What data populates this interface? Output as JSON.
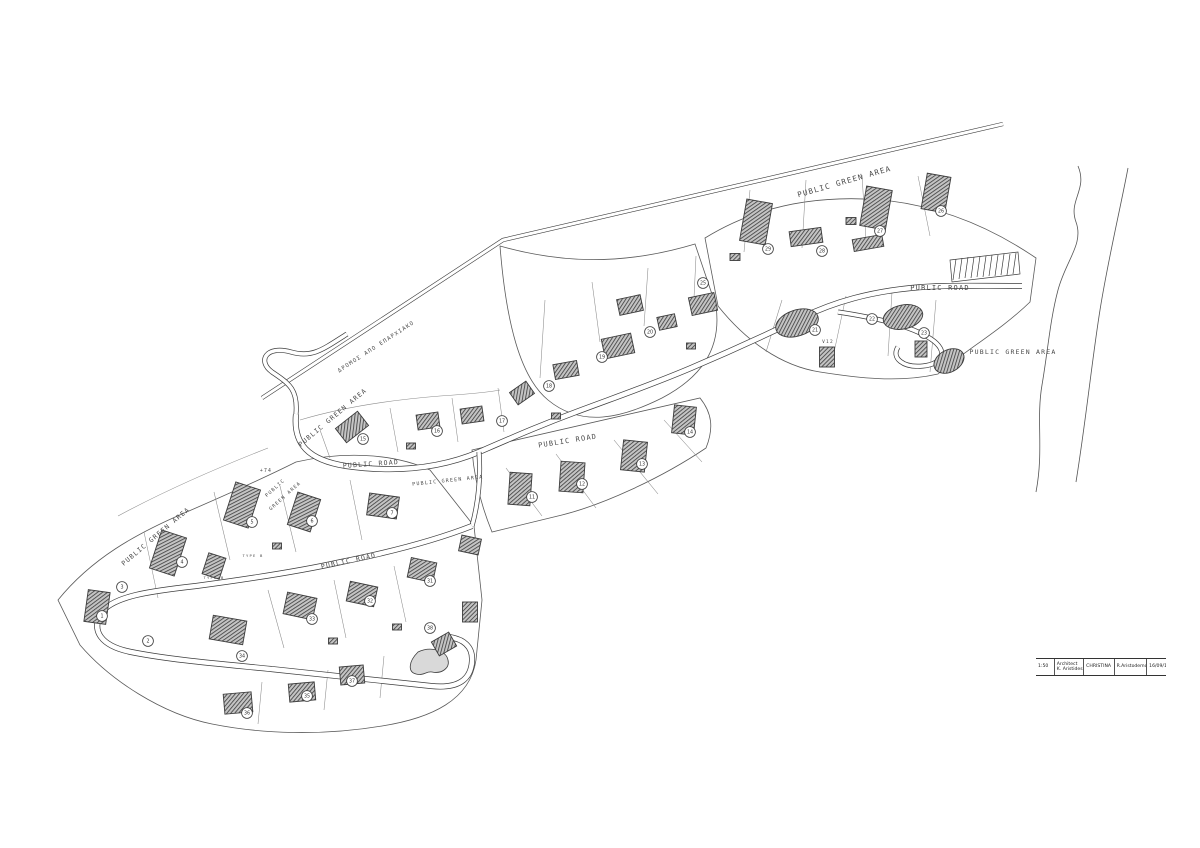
{
  "colors": {
    "line": "#3c3c3c",
    "faint": "#8a8a8a",
    "building_hatch": "#3a3a3a",
    "background": "#ffffff"
  },
  "labels": [
    {
      "text": "PUBLIC GREEN AREA",
      "x": 845,
      "y": 184,
      "rot": -16,
      "size": 7.5
    },
    {
      "text": "PUBLIC ROAD",
      "x": 940,
      "y": 290,
      "rot": 0,
      "size": 7
    },
    {
      "text": "PUBLIC GREEN AREA",
      "x": 1013,
      "y": 354,
      "rot": 0,
      "size": 6.5
    },
    {
      "text": "PUBLIC ROAD",
      "x": 568,
      "y": 443,
      "rot": -9,
      "size": 7
    },
    {
      "text": "PUBLIC ROAD",
      "x": 371,
      "y": 466,
      "rot": -4,
      "size": 6.5
    },
    {
      "text": "PUBLIC GREEN AREA",
      "x": 448,
      "y": 482,
      "rot": -6,
      "size": 5
    },
    {
      "text": "PUBLIC",
      "x": 276,
      "y": 489,
      "rot": -42,
      "size": 4.8
    },
    {
      "text": "GREEN AREA",
      "x": 286,
      "y": 497,
      "rot": -42,
      "size": 4.8
    },
    {
      "text": "+74",
      "x": 266,
      "y": 472,
      "rot": 0,
      "size": 4.8
    },
    {
      "text": "PUBLIC GREEN AREA",
      "x": 334,
      "y": 419,
      "rot": -40,
      "size": 6.5
    },
    {
      "text": "PUBLIC GREEN AREA",
      "x": 157,
      "y": 538,
      "rot": -40,
      "size": 6.5
    },
    {
      "text": "PUBLIC ROAD",
      "x": 349,
      "y": 563,
      "rot": -12,
      "size": 6.5
    },
    {
      "text": "ΔΡΟΜΟΣ ΑΠΟ ΕΠΑΡΧΙΑΚΟ",
      "x": 377,
      "y": 348,
      "rot": -33,
      "size": 5.5
    },
    {
      "text": "V12",
      "x": 828,
      "y": 343,
      "rot": 0,
      "size": 4.5
    },
    {
      "text": "TYPE B",
      "x": 214,
      "y": 579,
      "rot": 0,
      "size": 3.8
    },
    {
      "text": "TYPE B",
      "x": 253,
      "y": 557,
      "rot": 0,
      "size": 3.8
    }
  ],
  "plots": [
    {
      "n": "29",
      "x": 768,
      "y": 249
    },
    {
      "n": "28",
      "x": 822,
      "y": 251
    },
    {
      "n": "27",
      "x": 880,
      "y": 231
    },
    {
      "n": "26",
      "x": 941,
      "y": 211
    },
    {
      "n": "25",
      "x": 703,
      "y": 283
    },
    {
      "n": "21",
      "x": 815,
      "y": 330
    },
    {
      "n": "22",
      "x": 872,
      "y": 319
    },
    {
      "n": "23",
      "x": 924,
      "y": 333
    },
    {
      "n": "20",
      "x": 650,
      "y": 332
    },
    {
      "n": "19",
      "x": 602,
      "y": 357
    },
    {
      "n": "18",
      "x": 549,
      "y": 386
    },
    {
      "n": "17",
      "x": 502,
      "y": 421
    },
    {
      "n": "16",
      "x": 437,
      "y": 431
    },
    {
      "n": "15",
      "x": 363,
      "y": 439
    },
    {
      "n": "11",
      "x": 532,
      "y": 497
    },
    {
      "n": "12",
      "x": 582,
      "y": 484
    },
    {
      "n": "13",
      "x": 642,
      "y": 464
    },
    {
      "n": "14",
      "x": 690,
      "y": 432
    },
    {
      "n": "7",
      "x": 392,
      "y": 513
    },
    {
      "n": "6",
      "x": 312,
      "y": 521
    },
    {
      "n": "5",
      "x": 252,
      "y": 522
    },
    {
      "n": "4",
      "x": 182,
      "y": 562
    },
    {
      "n": "3",
      "x": 122,
      "y": 587
    },
    {
      "n": "1",
      "x": 102,
      "y": 616
    },
    {
      "n": "2",
      "x": 148,
      "y": 641
    },
    {
      "n": "31",
      "x": 430,
      "y": 581
    },
    {
      "n": "32",
      "x": 370,
      "y": 601
    },
    {
      "n": "33",
      "x": 312,
      "y": 619
    },
    {
      "n": "34",
      "x": 242,
      "y": 656
    },
    {
      "n": "35",
      "x": 307,
      "y": 696
    },
    {
      "n": "36",
      "x": 247,
      "y": 713
    },
    {
      "n": "37",
      "x": 352,
      "y": 681
    },
    {
      "n": "38",
      "x": 430,
      "y": 628
    }
  ],
  "villas": [
    {
      "x": 756,
      "y": 222,
      "w": 26,
      "h": 42,
      "r": 10
    },
    {
      "x": 806,
      "y": 237,
      "w": 32,
      "h": 15,
      "r": -8
    },
    {
      "x": 876,
      "y": 208,
      "w": 26,
      "h": 40,
      "r": 10
    },
    {
      "x": 936,
      "y": 193,
      "w": 24,
      "h": 36,
      "r": 10
    },
    {
      "x": 868,
      "y": 243,
      "w": 30,
      "h": 12,
      "r": -10
    },
    {
      "x": 703,
      "y": 304,
      "w": 26,
      "h": 18,
      "r": -12
    },
    {
      "x": 667,
      "y": 322,
      "w": 18,
      "h": 13,
      "r": -12
    },
    {
      "x": 827,
      "y": 357,
      "w": 15,
      "h": 20,
      "r": 0
    },
    {
      "x": 921,
      "y": 349,
      "w": 12,
      "h": 16,
      "r": 0
    },
    {
      "x": 630,
      "y": 305,
      "w": 24,
      "h": 16,
      "r": -12
    },
    {
      "x": 618,
      "y": 346,
      "w": 30,
      "h": 20,
      "r": -12
    },
    {
      "x": 566,
      "y": 370,
      "w": 24,
      "h": 15,
      "r": -10
    },
    {
      "x": 522,
      "y": 393,
      "w": 20,
      "h": 15,
      "r": -35
    },
    {
      "x": 472,
      "y": 415,
      "w": 22,
      "h": 15,
      "r": -8
    },
    {
      "x": 428,
      "y": 421,
      "w": 22,
      "h": 15,
      "r": -8
    },
    {
      "x": 352,
      "y": 427,
      "w": 28,
      "h": 18,
      "r": -38
    },
    {
      "x": 520,
      "y": 489,
      "w": 22,
      "h": 32,
      "r": 4
    },
    {
      "x": 572,
      "y": 477,
      "w": 24,
      "h": 30,
      "r": 4
    },
    {
      "x": 634,
      "y": 456,
      "w": 24,
      "h": 30,
      "r": 6
    },
    {
      "x": 684,
      "y": 420,
      "w": 22,
      "h": 28,
      "r": 6
    },
    {
      "x": 242,
      "y": 505,
      "w": 26,
      "h": 40,
      "r": 18
    },
    {
      "x": 304,
      "y": 512,
      "w": 24,
      "h": 34,
      "r": 18
    },
    {
      "x": 383,
      "y": 506,
      "w": 30,
      "h": 22,
      "r": 8
    },
    {
      "x": 168,
      "y": 553,
      "w": 26,
      "h": 40,
      "r": 18
    },
    {
      "x": 214,
      "y": 566,
      "w": 18,
      "h": 22,
      "r": 18
    },
    {
      "x": 300,
      "y": 606,
      "w": 30,
      "h": 22,
      "r": 12
    },
    {
      "x": 362,
      "y": 594,
      "w": 28,
      "h": 20,
      "r": 12
    },
    {
      "x": 422,
      "y": 570,
      "w": 26,
      "h": 20,
      "r": 12
    },
    {
      "x": 470,
      "y": 545,
      "w": 20,
      "h": 16,
      "r": 12
    },
    {
      "x": 228,
      "y": 630,
      "w": 34,
      "h": 24,
      "r": 10
    },
    {
      "x": 97,
      "y": 607,
      "w": 22,
      "h": 32,
      "r": 8
    },
    {
      "x": 238,
      "y": 703,
      "w": 28,
      "h": 20,
      "r": -5
    },
    {
      "x": 302,
      "y": 692,
      "w": 26,
      "h": 18,
      "r": -5
    },
    {
      "x": 352,
      "y": 675,
      "w": 24,
      "h": 18,
      "r": -5
    },
    {
      "x": 444,
      "y": 644,
      "w": 20,
      "h": 16,
      "r": -30
    },
    {
      "x": 470,
      "y": 612,
      "w": 15,
      "h": 20,
      "r": 0
    },
    {
      "x": 735,
      "y": 257,
      "w": 10,
      "h": 7,
      "r": 0
    },
    {
      "x": 851,
      "y": 221,
      "w": 10,
      "h": 7,
      "r": 0
    },
    {
      "x": 691,
      "y": 346,
      "w": 9,
      "h": 6,
      "r": 0
    },
    {
      "x": 556,
      "y": 416,
      "w": 9,
      "h": 6,
      "r": 0
    },
    {
      "x": 411,
      "y": 446,
      "w": 9,
      "h": 6,
      "r": 0
    },
    {
      "x": 277,
      "y": 546,
      "w": 9,
      "h": 6,
      "r": 0
    },
    {
      "x": 333,
      "y": 641,
      "w": 9,
      "h": 6,
      "r": 0
    },
    {
      "x": 397,
      "y": 627,
      "w": 9,
      "h": 6,
      "r": 0
    },
    {
      "shape": "ellipse",
      "x": 797,
      "y": 323,
      "rx": 22,
      "ry": 13,
      "r": -18
    },
    {
      "shape": "ellipse",
      "x": 903,
      "y": 317,
      "rx": 20,
      "ry": 12,
      "r": -12
    },
    {
      "shape": "ellipse",
      "x": 949,
      "y": 361,
      "rx": 16,
      "ry": 11,
      "r": -28
    }
  ],
  "title_block": {
    "scale": "1:50",
    "role": "Architect",
    "architect": "K. Aristides",
    "project": "CHRISTINA",
    "client": "R.Aristodemou",
    "date": "16/09/15"
  }
}
